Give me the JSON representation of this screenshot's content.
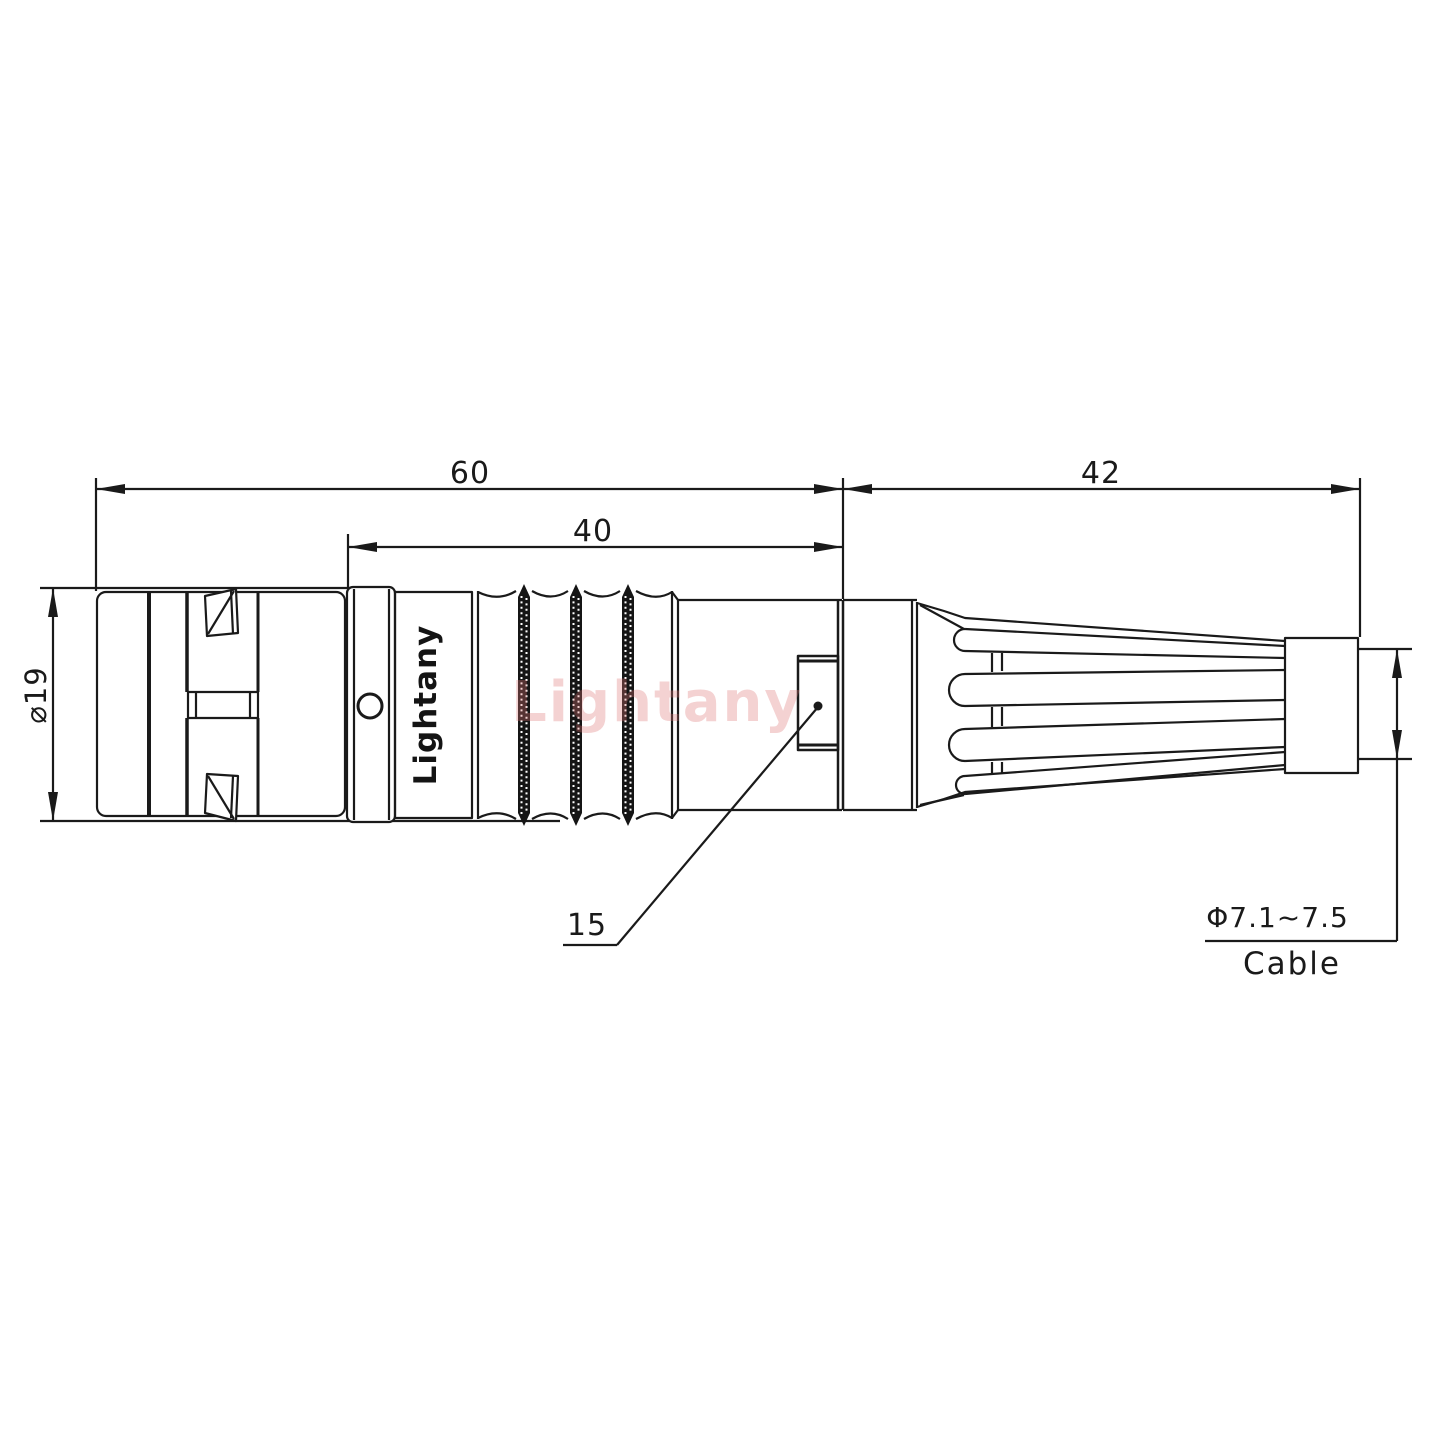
{
  "drawing": {
    "type": "engineering-2d-connector-drawing",
    "part": "push-pull circular connector plug with strain relief boot",
    "colors": {
      "line": "#1a1a1a",
      "background": "#ffffff",
      "watermark": "#de7474",
      "knurl_fill": "#151515"
    },
    "dimensions": {
      "overall_length_label": "60",
      "grip_length_label": "40",
      "boot_length_label": "42",
      "front_diameter_label": "⌀19",
      "key_leader_label": "15",
      "cable_diameter_label": "Φ7.1~7.5",
      "cable_caption": "Cable"
    },
    "branding": {
      "body_logo": "Lightany",
      "watermark": "Lightany"
    }
  }
}
